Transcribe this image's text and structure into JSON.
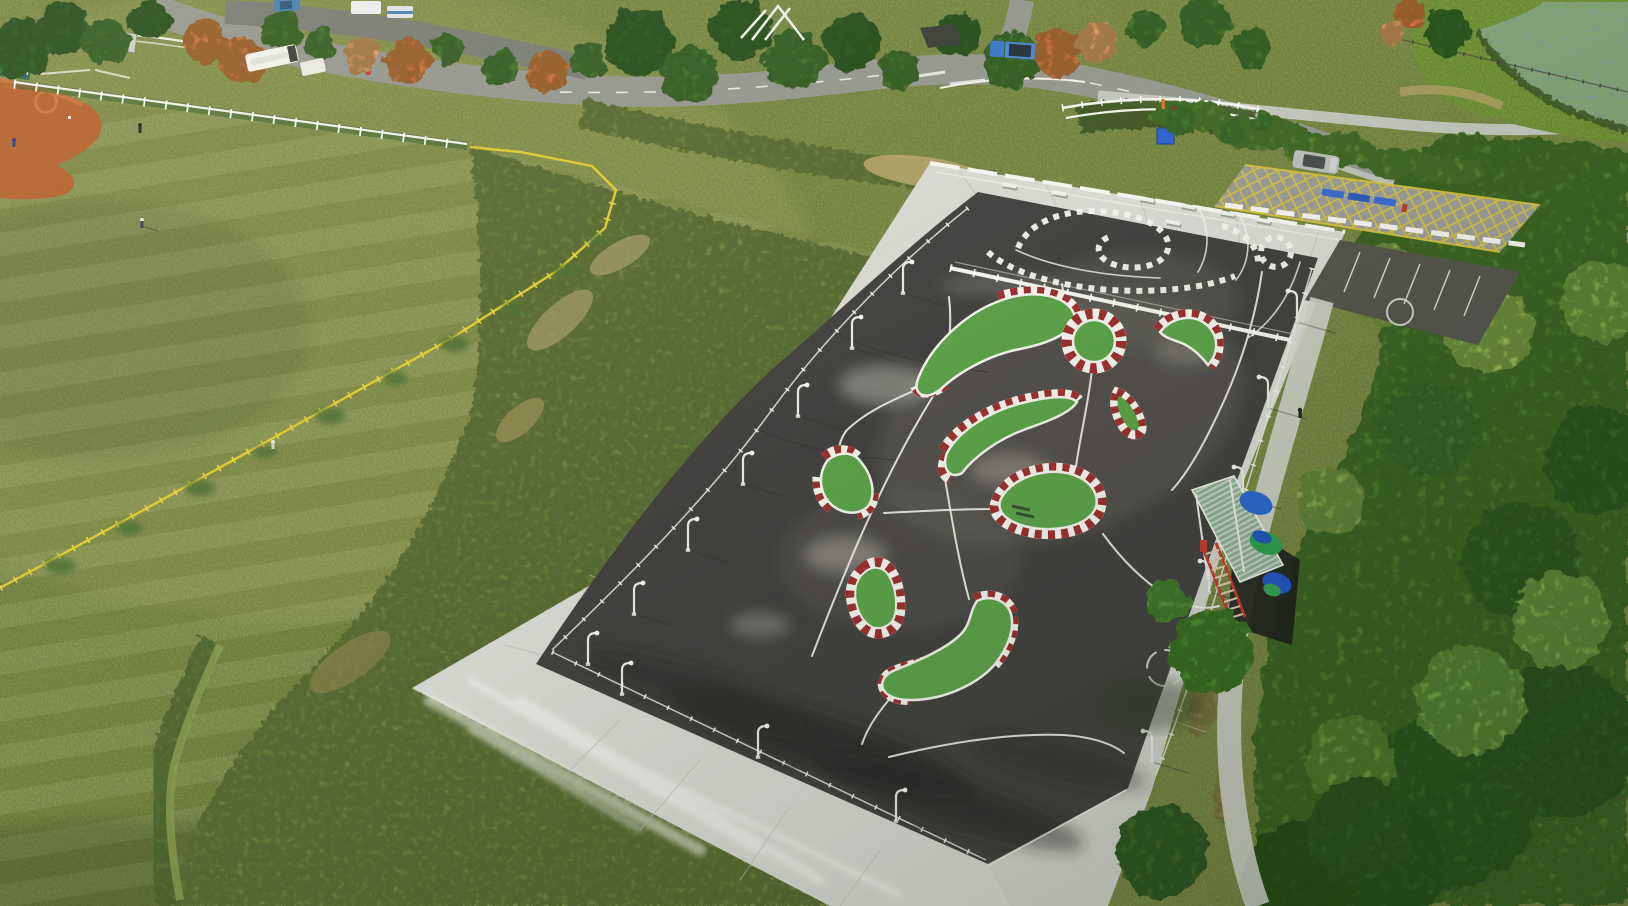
{
  "scene": {
    "title": "Aerial drone view of a candy-stripe RC car track in a riverside sports park",
    "description": "Oblique top-down photo: a dark asphalt remote-control car circuit with green painted islands edged in red-and-white candy stripes sits on a white concrete apron, surrounded by a mowed meadow, a baseball infield corner, park roads with vehicles, dense wild vegetation and a lily-pad pond.",
    "setting": "public riverside sports park",
    "camera": "oblique aerial drone view",
    "lighting": "low warm late-afternoon sun from the upper left"
  },
  "palette": {
    "field": "#86964f",
    "fieldLight": "#9aa85c",
    "fieldDark": "#6e8042",
    "scrub": "#6d7f3e",
    "vegetation": "#507b2f",
    "canopyDark": "#35602a",
    "canopyLight": "#79aa42",
    "treeGreen": "#3c6a2d",
    "treeOrange": "#d0713f",
    "treeOrangeLight": "#e09a62",
    "pond": "#7a98a0",
    "lilyPad": "#85a66b",
    "clay": "#b4622e",
    "roadGray": "#94978f",
    "pathGray": "#c2c5ba",
    "concrete": "#d7d9d2",
    "asphalt": "#434240",
    "asphaltWorn": "#6b6a62",
    "islandGreen": "#5ca24a",
    "curbRed": "#9b3130",
    "paintWhite": "#f2f3ec",
    "fenceYellow": "#ddca33",
    "roofGreen": "#8fae93",
    "tarpBlue": "#2a66cc",
    "tarpGreen": "#2f9e4f",
    "stairRed": "#c23b30",
    "courtGreen": "#2d6a45",
    "truckBlue": "#3a78c9",
    "suvSilver": "#b9bdb9"
  },
  "track": {
    "label": "RC car circuit",
    "surface": "dark asphalt with chalky tire wear",
    "sections": [
      {
        "label": "upper practice loop with dotted white curbs"
      },
      {
        "label": "main circuit with green islands"
      }
    ],
    "island_count": 9,
    "roundabout_count": 1,
    "curb_style": "red and white candy stripes",
    "line_color": "white"
  },
  "structures": {
    "drivers_stand": {
      "label": "elevated drivers' stand",
      "roof": "pale green corrugated sheet",
      "tarps": [
        "blue",
        "green"
      ],
      "staircase": "red steel stair"
    },
    "lamp_count": 16,
    "bench_count": 7,
    "fences": [
      "white perimeter railing",
      "yellow field fence",
      "white ballfield mesh fence",
      "white road guardrail"
    ]
  },
  "surroundings": {
    "baseball_field": {
      "label": "baseball infield corner",
      "clay_color": "orange",
      "mound": "pitcher's mound"
    },
    "meadow": {
      "label": "mowed grass meadow",
      "pattern": "diagonal mow stripes"
    },
    "pond": {
      "label": "lotus pond",
      "cover": "lily pads"
    },
    "roads": {
      "markings": [
        "white dashed centerline",
        "yellow no-stopping hatch"
      ],
      "bridge": "white guardrail culvert"
    },
    "vehicles": [
      {
        "type": "minibus",
        "color": "white"
      },
      {
        "type": "van",
        "color": "white"
      },
      {
        "type": "car",
        "color": "blue"
      },
      {
        "type": "flatbed truck",
        "color": "blue"
      },
      {
        "type": "suv",
        "color": "silver"
      }
    ],
    "people": [
      {
        "where": "baseball infield"
      },
      {
        "where": "meadow outfield"
      },
      {
        "where": "riverside path",
        "detail": "walking a dog"
      },
      {
        "where": "track apron"
      }
    ]
  }
}
